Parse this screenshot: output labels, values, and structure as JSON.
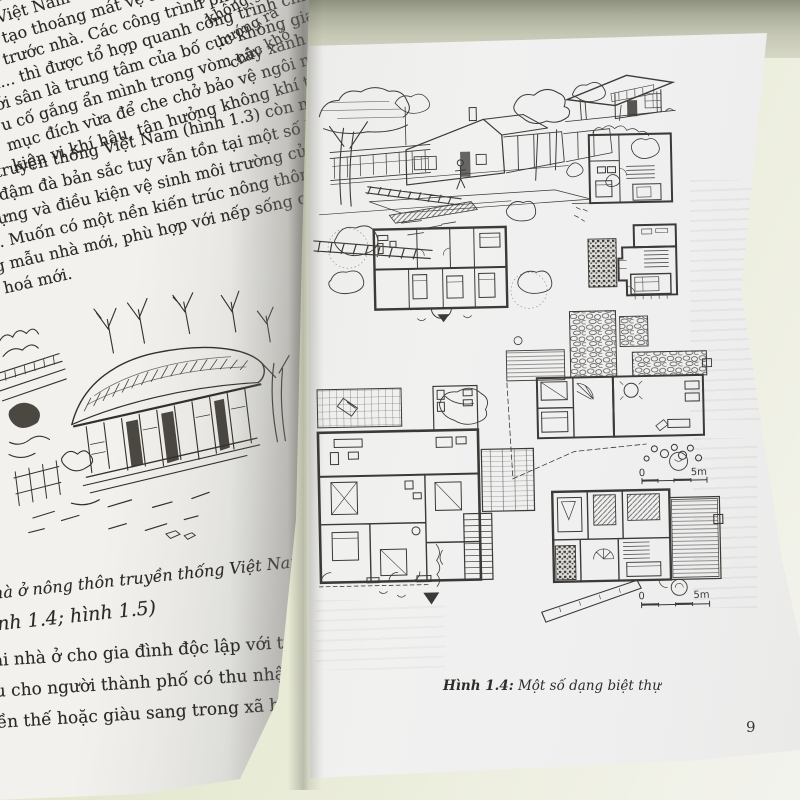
{
  "left_page": {
    "edge_fragments": [
      "g nước...).",
      "không gian nửa kín",
      "hướng ra",
      "chức khô"
    ],
    "para1": [
      "ơ của nhà nông thôn thì ngư",
      "ở nhất của khu đất, được sử dụng làm",
      "phơi trước ngôi nhà chính đã nói lên đặc",
      "ản Việt Nam và mang tác dụng rõ rệt: nơi tiến hành",
      "an tạo thoáng mát vệ sinh cho ngôi nhà chính. Ao cá",
      "ó, trước nhà. Các công trình phụ như bếp, chuồng trại",
      "ụ... thì được tổ hợp quanh công trình chính, ôm lấy cái",
      "ới sân là trung tâm của bố cục không gian sinh hoạt gia đình",
      "u cố gắng ẩn mình trong vòm cây xanh của cây lấy gỗ",
      "mục đích vừa để che chở bảo vệ ngôi nhà chính chống",
      "kiện vi khí hậu, tận hưởng không khí trong lành."
    ],
    "para2": [
      "thôn truyền thống Việt Nam (hình 1.3) còn mang đậm",
      "gian đậm đà bản sắc tuy vẫn tồn tại một số hạn chế về",
      "ây dựng và điều kiện vệ sinh môi trường của nền ki",
      "hậu. Muốn có một nền kiến trúc nông thôn mới thì ch",
      "ững mẫu nhà mới, phù hợp với nếp sống của thời đại",
      "ăn hoá mới."
    ],
    "sketch_caption": "hà ở nông thôn truyền thống Việt Nam",
    "figure_refs": "ình 1.4; hình 1.5)",
    "para3": [
      "ại nhà ở cho gia đình độc lập với tiện nghi sang",
      "u cho người thành phố có thu nhập kinh tế và đ",
      "ền thế hoặc giàu sang trong xã hội."
    ]
  },
  "right_page": {
    "caption_label": "Hình 1.4:",
    "caption_text": " Một số dạng biệt thự",
    "scale_bar_1": {
      "zero": "0",
      "max": "5m"
    },
    "scale_bar_2": {
      "zero": "0",
      "max": "5m"
    },
    "page_number": "9"
  },
  "colors": {
    "desk_green": "#dce0c0",
    "desk_shadow": "#8e9080",
    "paper": "#f1f1f0",
    "ink_text": "#2b2925",
    "ink_drawing": "#3c3a36"
  }
}
